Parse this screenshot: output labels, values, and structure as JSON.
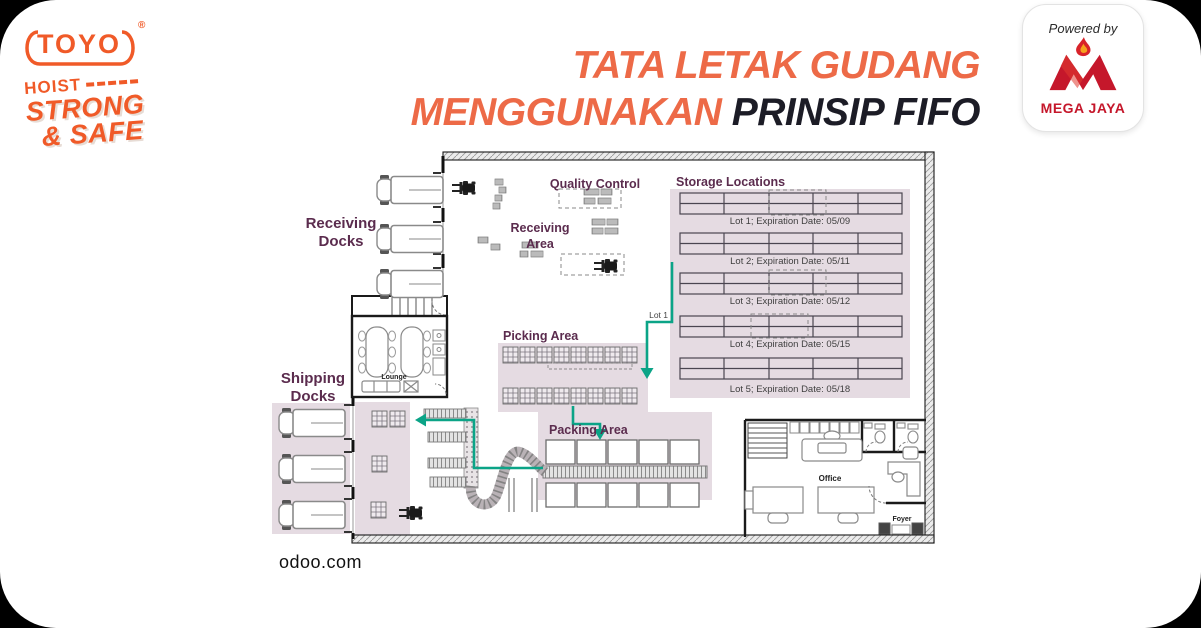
{
  "header": {
    "toyo": {
      "name": "TOYO",
      "reg": "®",
      "sub1": "HOIST",
      "sub2": "STRONG",
      "sub3": "& SAFE"
    },
    "title": {
      "line1": "TATA LETAK GUDANG",
      "line2_orange": "MENGGUNAKAN",
      "line2_dark": "PRINSIP FIFO"
    },
    "powered": {
      "label": "Powered by",
      "brand": "MEGA JAYA"
    }
  },
  "plan": {
    "labels": {
      "receiving_docks_1": "Receiving",
      "receiving_docks_2": "Docks",
      "quality_control": "Quality Control",
      "receiving_area_1": "Receiving",
      "receiving_area_2": "Area",
      "storage_locations": "Storage Locations",
      "picking_area": "Picking Area",
      "packing_area": "Packing Area",
      "shipping_docks_1": "Shipping",
      "shipping_docks_2": "Docks",
      "lounge": "Lounge",
      "office": "Office",
      "foyer": "Foyer",
      "lot1_flow": "Lot 1"
    },
    "lots": [
      "Lot 1; Expiration Date: 05/09",
      "Lot 2; Expiration Date: 05/11",
      "Lot 3; Expiration Date: 05/12",
      "Lot 4; Expiration Date: 05/15",
      "Lot 5; Expiration Date: 05/18"
    ],
    "source": "odoo.com"
  },
  "colors": {
    "orange_title": "#ED6A47",
    "orange_logo": "#F05A28",
    "dark_title": "#1C1C26",
    "label_plum": "#5B2C4E",
    "flow_teal": "#0BA487",
    "area_lavender": "#E5DBE2",
    "mega_red": "#C5172B"
  }
}
